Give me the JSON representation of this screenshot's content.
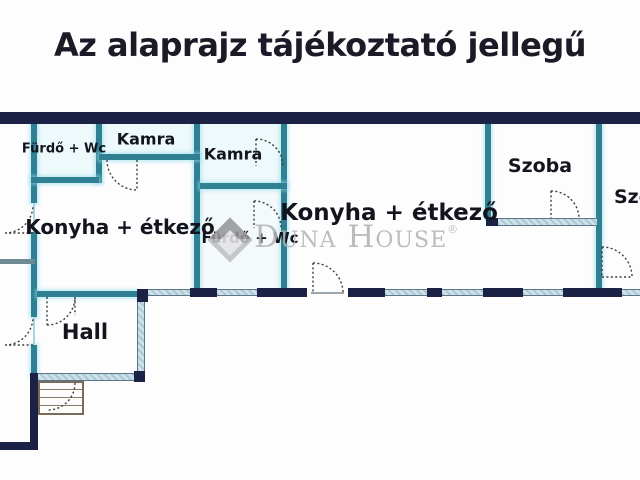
{
  "title": "Az alaprajz tájékoztató jellegű",
  "watermark": {
    "brand": "Duna House",
    "registered": "®"
  },
  "floor_plan": {
    "rooms": {
      "furdo_wc_1": {
        "label": "Fürdő + Wc"
      },
      "kamra_1": {
        "label": "Kamra"
      },
      "kamra_2": {
        "label": "Kamra"
      },
      "konyha_etkezo_1": {
        "label": "Konyha + étkező"
      },
      "furdo_wc_2": {
        "label": "Fürdő + Wc"
      },
      "konyha_etkezo_2": {
        "label": "Konyha + étkező"
      },
      "szoba_1": {
        "label": "Szoba"
      },
      "szoba_2": {
        "label": "Szoba"
      },
      "hall": {
        "label": "Hall"
      }
    },
    "colors": {
      "exterior_wall": "#1b2246",
      "interior_wall": "#2e8092",
      "wall_glow": "#d9f3f8",
      "hatch_fill": "#cfe0e9",
      "hatch_line": "#a9c8d6",
      "door_arc": "#3c3c3c",
      "stairs_border": "#7b6a58",
      "watermark_gray": "#b4b4b6",
      "title_color": "#1b1b28"
    }
  }
}
